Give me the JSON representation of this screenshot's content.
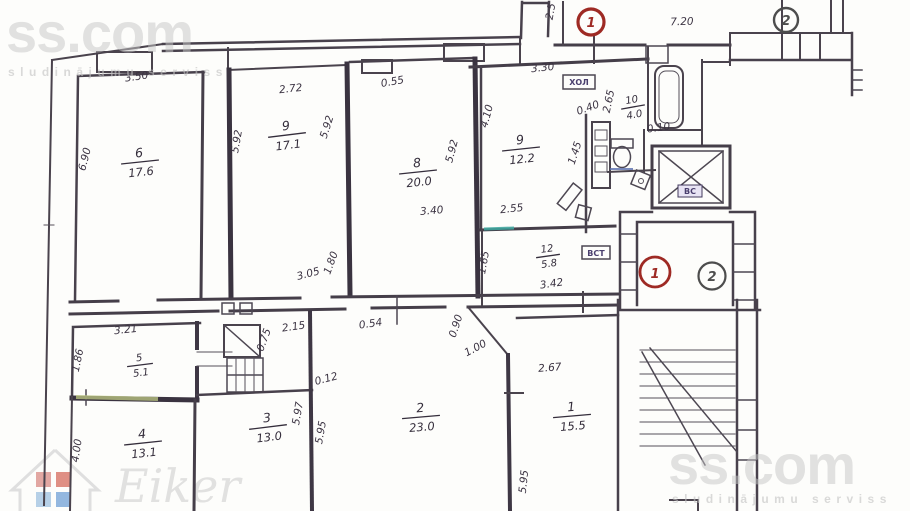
{
  "watermarks": {
    "brand": "ss.com",
    "tagline": "sludinājumu serviss",
    "agency": "Eiker"
  },
  "colors": {
    "ink": "#453e49",
    "marker_red": "#9e2a24",
    "marker_gray": "#4d4d4d",
    "accent_teal": "#3fa8a0",
    "accent_green": "#c9d489",
    "accent_blue": "#5a6fae",
    "label_purple": "#4a3f6e",
    "watermark_gray": "#c6c6c6"
  },
  "markers": {
    "top1": "1",
    "top2": "2",
    "stair1": "1",
    "stair2": "2"
  },
  "boxes": {
    "hall": "ХОЛ",
    "vst": "ВСТ",
    "vs": "ВС"
  },
  "rooms": {
    "r6": {
      "num": "6",
      "area": "17.6"
    },
    "r9a": {
      "num": "9",
      "area": "17.1"
    },
    "r8": {
      "num": "8",
      "area": "20.0"
    },
    "r9b": {
      "num": "9",
      "area": "12.2"
    },
    "r10": {
      "num": "10",
      "area": "4.0"
    },
    "r12": {
      "num": "12",
      "area": "5.8"
    },
    "r5": {
      "num": "5",
      "area": "5.1"
    },
    "r4": {
      "num": "4",
      "area": "13.1"
    },
    "r3": {
      "num": "3",
      "area": "13.0"
    },
    "r2": {
      "num": "2",
      "area": "23.0"
    },
    "r1": {
      "num": "1",
      "area": "15.5"
    }
  },
  "dims": {
    "t350": "3.50",
    "l690": "6.90",
    "l592": "5.92",
    "t272": "2.72",
    "r592": "5.92",
    "b305": "3.05",
    "b180": "1.80",
    "t055": "0.55",
    "r592b": "5.92",
    "c340": "3.40",
    "l410": "4.10",
    "t330": "3.30",
    "t25": "2.5",
    "t720": "7.20",
    "v265": "2.65",
    "v040": "0.40",
    "v010": "0.10",
    "v145": "1.45",
    "c255": "2.55",
    "v165": "1.65",
    "c342": "3.42",
    "t321": "3.21",
    "l186": "1.86",
    "l400": "4.00",
    "t215": "2.15",
    "v075": "0.75",
    "v012": "0.12",
    "v597": "5.97",
    "v595": "5.95",
    "c054": "0.54",
    "v090": "0.90",
    "v100": "1.00",
    "c267": "2.67",
    "v595b": "5.95"
  }
}
